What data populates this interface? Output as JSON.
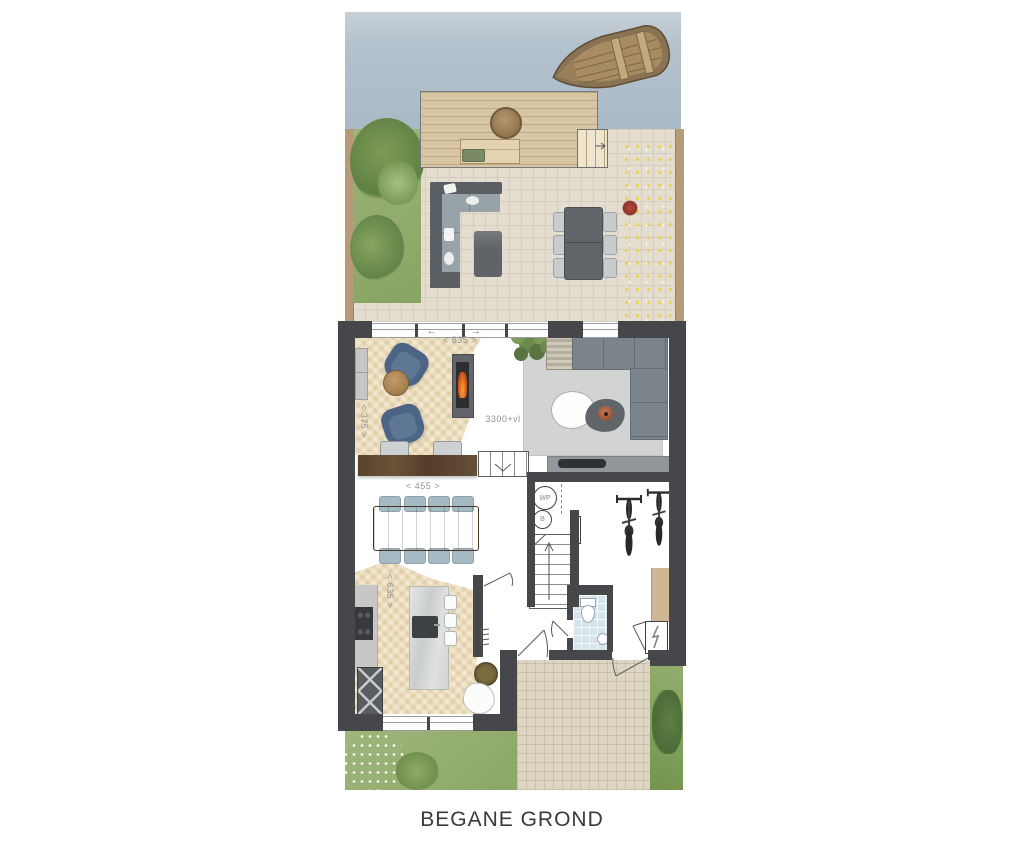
{
  "title": "BEGANE GROND",
  "dimensions": {
    "living_width": "< 835 >",
    "living_depth": "< 375 >",
    "dining_width": "< 455 >",
    "kitchen_depth": "< 635 >",
    "ceiling_height": "3300+vl"
  },
  "equipment": {
    "heat_pump": "WP",
    "boiler": "B"
  },
  "indicators": {
    "slide_left": "←",
    "slide_right": "→"
  },
  "icons": {
    "electric_meter": "lightning-bolt-icon",
    "stairs_up": "arrow-up-icon",
    "steps_down": "chevron-down-icon",
    "deck_steps": "arrow-right-icon"
  },
  "colors": {
    "water": "#aabbc8",
    "grass": "#94af72",
    "terrace_paving": "#e4ddd0",
    "deck_wood": "#d8c5a3",
    "wall": "#45474a",
    "wood_floor": "#eadcba",
    "flame_accent": "#dd7621",
    "dimension_text": "#8f9295",
    "title_text": "#3a3a3a"
  }
}
